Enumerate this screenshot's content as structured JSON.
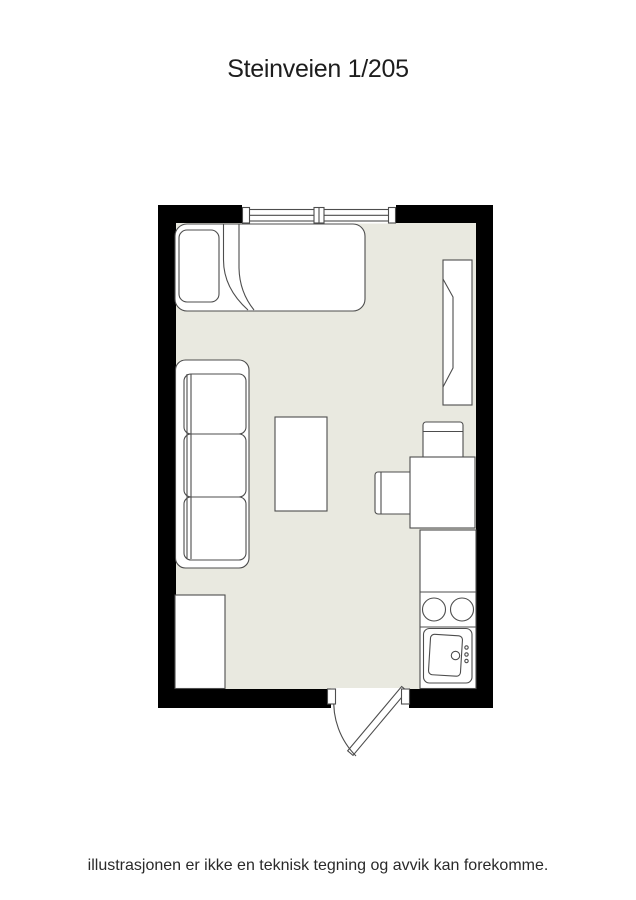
{
  "page": {
    "title": "Steinveien 1/205",
    "disclaimer": "illustrasjonen er ikke en teknisk tegning og avvik kan forekomme."
  },
  "colors": {
    "wall": "#000000",
    "floor": "#E9E9E0",
    "furniture_fill": "#FFFFFF",
    "outline": "#4D4D4D",
    "background": "#FFFFFF"
  },
  "floorplan": {
    "kind": "studio apartment floor plan",
    "features": [
      {
        "name": "window",
        "wall": "top"
      },
      {
        "name": "door",
        "wall": "bottom",
        "swing": "outward"
      }
    ],
    "furniture": [
      {
        "name": "bed",
        "details": "single bed with pillow and folded duvet"
      },
      {
        "name": "sofa",
        "details": "three-seat sofa against left wall"
      },
      {
        "name": "coffee-table"
      },
      {
        "name": "wardrobe",
        "details": "tall cabinet against right wall"
      },
      {
        "name": "dining-table",
        "details": "with two chairs"
      },
      {
        "name": "kitchen-counter",
        "details": "counter, two-burner stove, sink with faucet knobs"
      },
      {
        "name": "desk",
        "details": "bottom-left cabinet"
      }
    ]
  }
}
